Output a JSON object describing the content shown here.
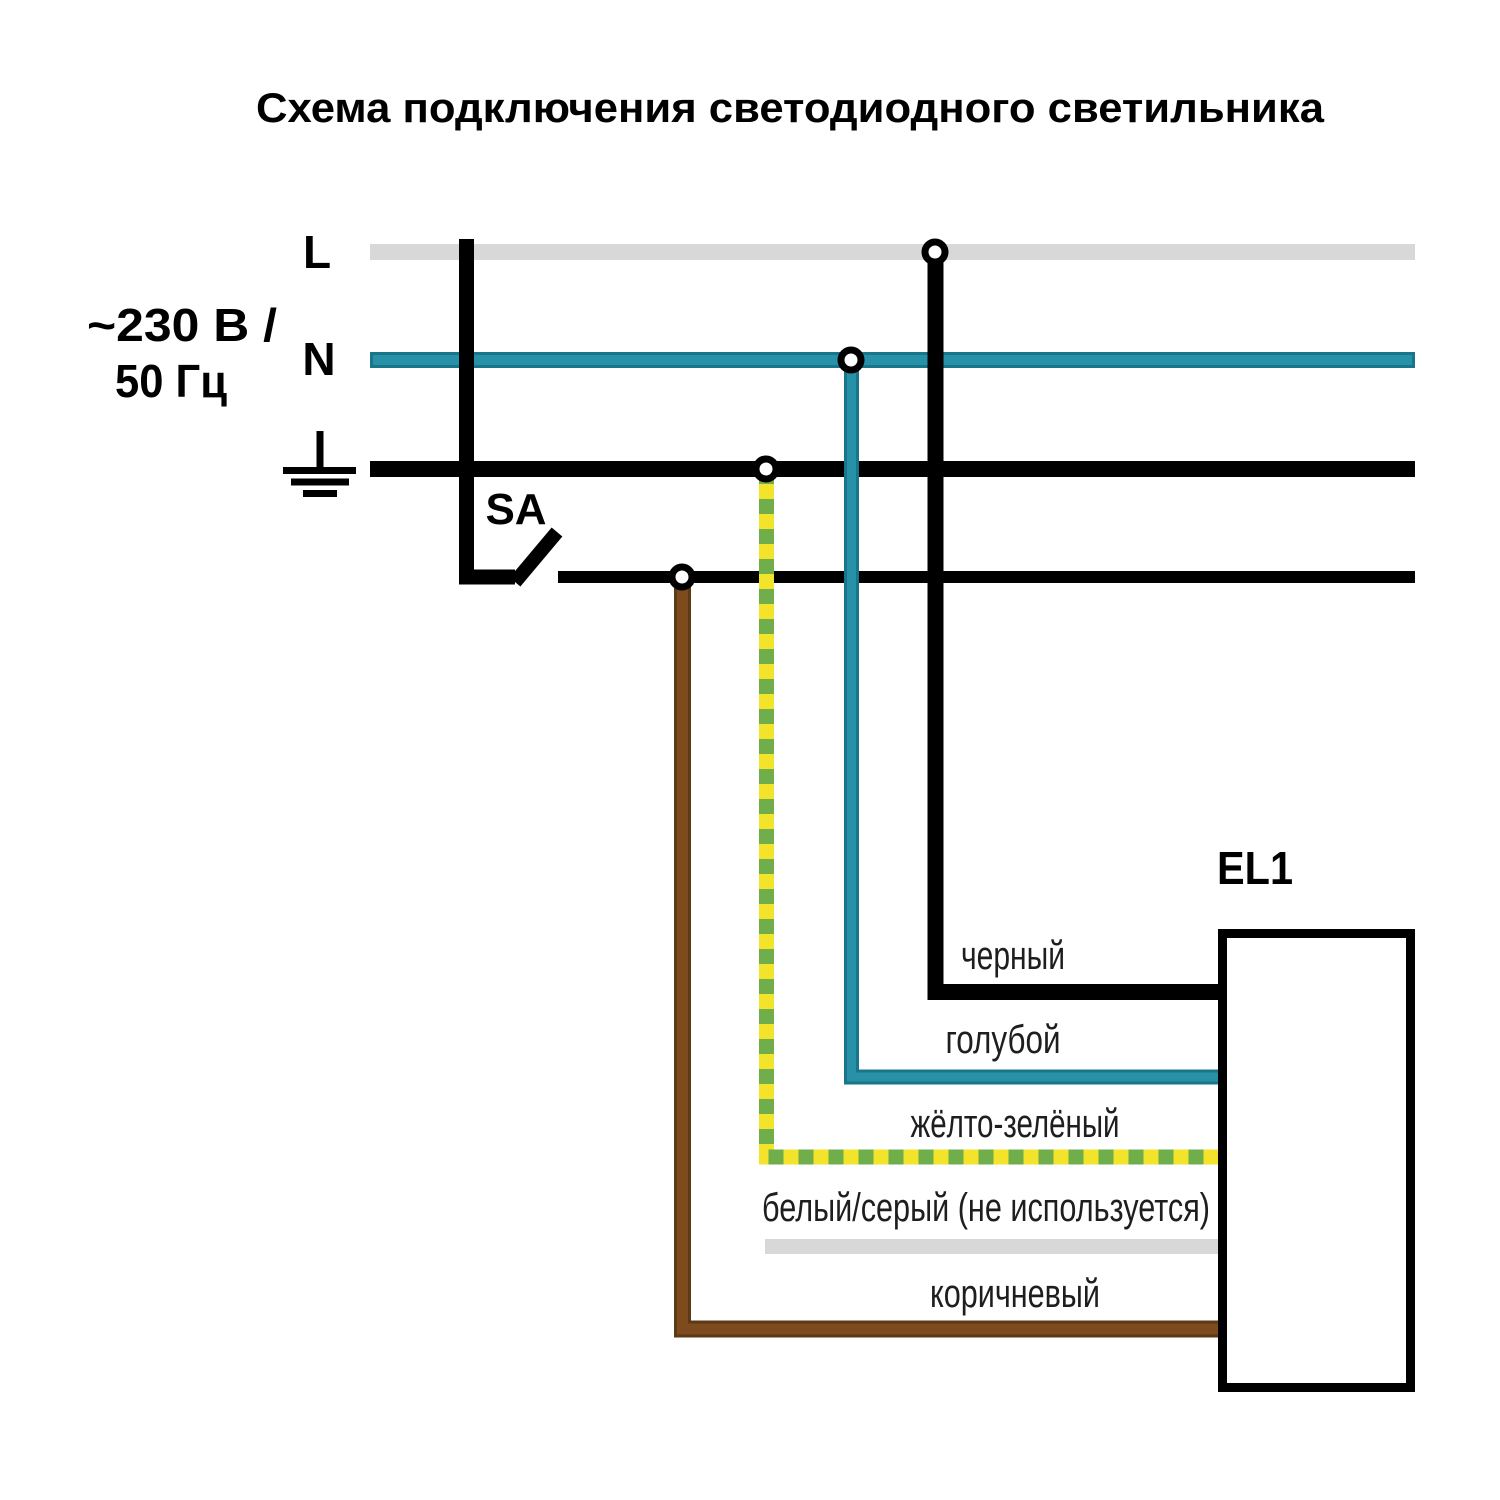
{
  "title": "Схема подключения светодиодного светильника",
  "power_source": {
    "line_label": "L",
    "neutral_label": "N",
    "voltage_line1": "~230 В /",
    "voltage_line2": "50 Гц"
  },
  "switch": {
    "label": "SA"
  },
  "luminaire": {
    "label": "EL1"
  },
  "wires": [
    {
      "id": "black",
      "label": "черный",
      "color": "#000000"
    },
    {
      "id": "blue",
      "label": "голубой",
      "color": "#2691a7"
    },
    {
      "id": "yellow-green",
      "label": "жёлто-зелёный",
      "color": "#f3e32b / #6fae4b"
    },
    {
      "id": "white-gray",
      "label": "белый/серый (не используется)",
      "color": "#d8d8d8"
    },
    {
      "id": "brown",
      "label": "коричневый",
      "color": "#7d4b1e"
    }
  ],
  "colors": {
    "bus_gray": "#d8d8d8",
    "teal": "#2691a7",
    "teal_border": "#19758a",
    "yellow": "#f3e32b",
    "green": "#6fae4b",
    "brown": "#7d4b1e",
    "brown_border": "#5e3a14",
    "unused_gray": "#d8d8d8",
    "wire_black": "#000000",
    "label_text": "#1e1e1e"
  }
}
